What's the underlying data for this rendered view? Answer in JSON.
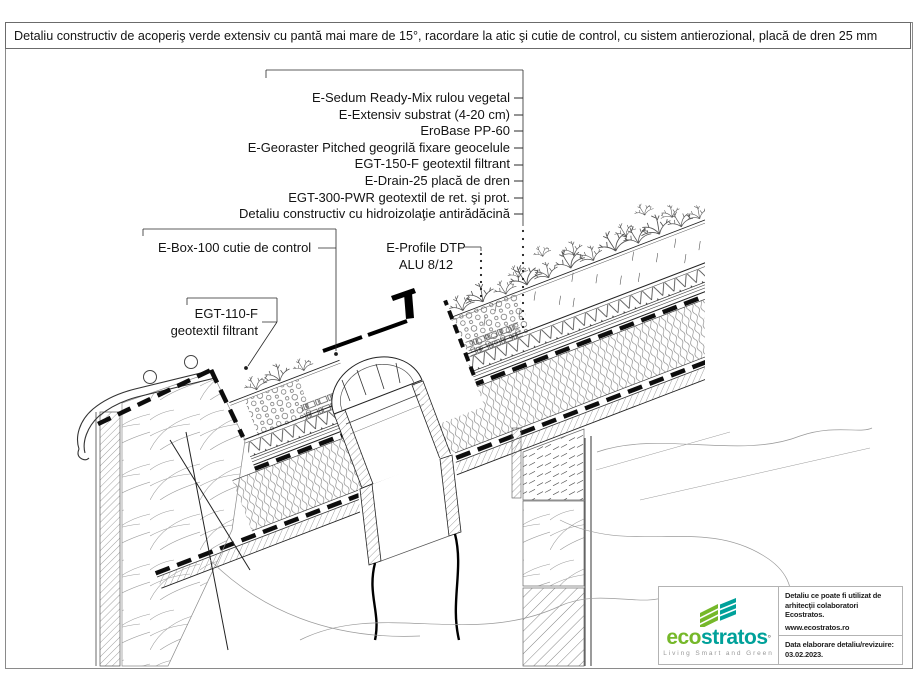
{
  "title": "Detaliu constructiv de acoperiş verde extensiv cu pantă mai mare de 15°, racordare la atic şi cutie de control, cu sistem antierozional, placă de dren 25 mm",
  "layer_labels": [
    "E-Sedum Ready-Mix rulou vegetal",
    "E-Extensiv substrat (4-20 cm)",
    "EroBase PP-60",
    "E-Georaster Pitched geogrilă fixare geocelule",
    "EGT-150-F geotextil filtrant",
    "E-Drain-25 placă de dren",
    "EGT-300-PWR geotextil de ret. şi prot.",
    "Detaliu constructiv cu hidroizolaţie antirădăcină"
  ],
  "callouts": {
    "control_box": "E-Box-100 cutie de control",
    "profile_line1": "E-Profile DTP",
    "profile_line2": "ALU 8/12",
    "geotextile_line1": "EGT-110-F",
    "geotextile_line2": "geotextil filtrant"
  },
  "footer": {
    "brand_eco": "eco",
    "brand_stratos": "stratos",
    "brand_mark": "°",
    "tagline": "Living Smart and Green",
    "note_line1": "Detaliu ce poate fi utilizat de",
    "note_line2": "arhitecţii colaboratori Ecostratos.",
    "website": "www.ecostratos.ro",
    "revision_label": "Data elaborare detaliu/revizuire:",
    "revision_date": "03.02.2023."
  },
  "colors": {
    "brand_green": "#76b82a",
    "brand_teal": "#00a19a"
  }
}
